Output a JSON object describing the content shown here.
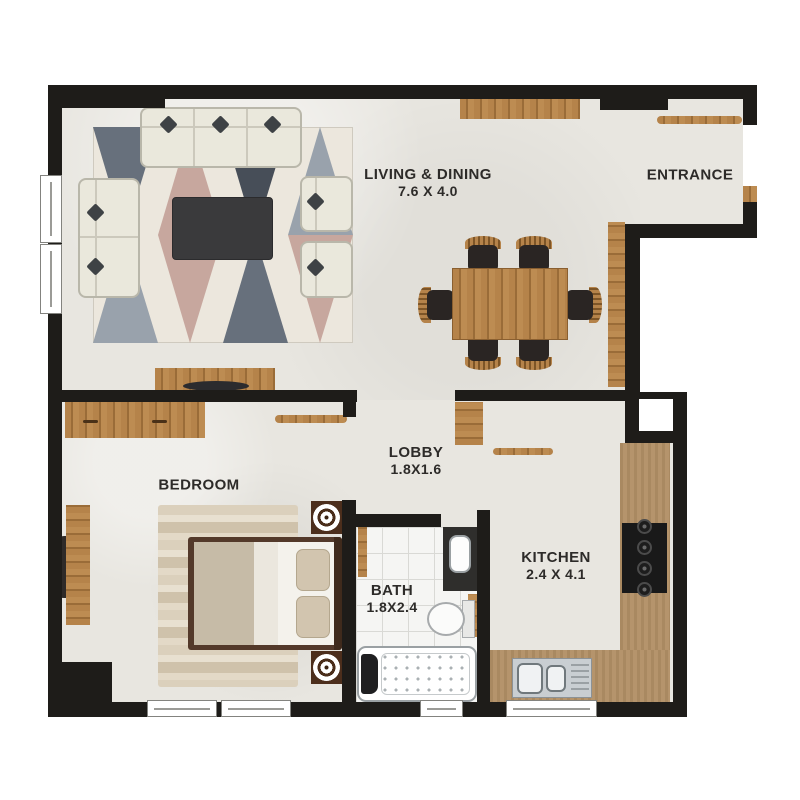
{
  "rooms": {
    "living": {
      "label": "LIVING & DINING",
      "dims": "7.6 X 4.0"
    },
    "entrance": {
      "label": "ENTRANCE"
    },
    "lobby": {
      "label": "LOBBY",
      "dims": "1.8X1.6"
    },
    "bedroom": {
      "label": "BEDROOM"
    },
    "bath": {
      "label": "BATH",
      "dims": "1.8X2.4"
    },
    "kitchen": {
      "label": "KITCHEN",
      "dims": "2.4 X 4.1"
    }
  },
  "colors": {
    "wall": "#1e1c19",
    "floor": "#e8e6e0",
    "wood": "#b5834a",
    "wood_dark": "#9a6c38",
    "counter": "#b29066",
    "rug_cream": "#ece7dd",
    "rug_slate": "#67707c",
    "rug_slate_light": "#99a2ac",
    "rug_pink": "#c7a79e",
    "rug_dark": "#474e58",
    "bedroom_rug": "#d8ccb6",
    "sofa": "#eae8dc",
    "sofa_edge": "#b9b7aa",
    "dark_furniture": "#332f2c",
    "bed_duvet": "#c6bba7",
    "nightstand": "#4c2e1c",
    "text": "#2d2b29"
  },
  "furniture": {
    "living": [
      "sofa-3-seat",
      "sofa-2-seat",
      "armchair",
      "armchair",
      "coffee-table",
      "geometric-rug",
      "tv-console",
      "sideboard",
      "tall-cabinet"
    ],
    "dining": [
      "dining-table",
      "dining-chair",
      "dining-chair",
      "dining-chair",
      "dining-chair",
      "dining-chair",
      "dining-chair"
    ],
    "entrance": [
      "console-shelf",
      "entry-door"
    ],
    "bedroom": [
      "wardrobe",
      "double-bed",
      "nightstand-lamp",
      "nightstand-lamp",
      "area-rug",
      "desk",
      "desk-chair"
    ],
    "bath": [
      "wash-basin",
      "toilet",
      "jacuzzi-bathtub",
      "door-leaf"
    ],
    "kitchen": [
      "l-counter",
      "cooktop-4-burner",
      "double-sink",
      "shelf",
      "door-leaf",
      "service-shaft"
    ]
  }
}
